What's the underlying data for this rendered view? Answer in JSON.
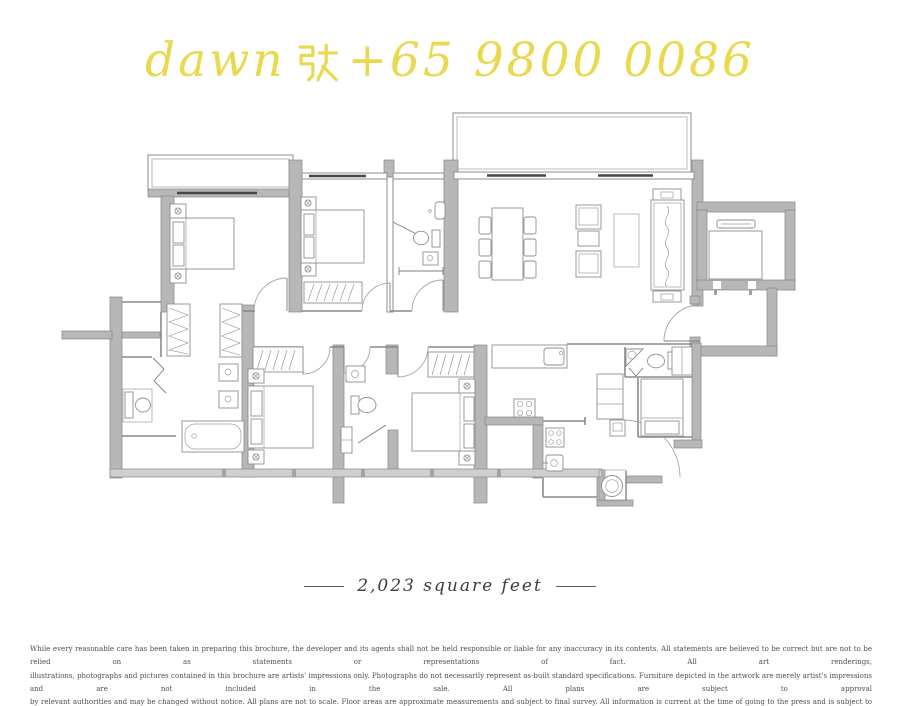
{
  "watermark": {
    "prefix": "dawn",
    "cjk": "张",
    "phone": "+65 9800 0086",
    "full_text": "dawn 张 +65 9800 0086"
  },
  "caption": {
    "area": "2,023 square feet"
  },
  "disclaimer": {
    "lines": [
      "While every reasonable care has been taken in preparing this brochure, the developer and its agents shall not be held responsible or liable for any inaccuracy in its contents. All statements are believed to be correct but are not to be relied on as statements or representations of fact. All art renderings,",
      "illustrations, photographs and pictures contained in this brochure are artists' impressions only. Photographs do not necessarily represent as-built standard specifications. Furniture depicted in the artwork are merely artist's impressions and are not included in the sale. All plans are subject to approval",
      "by relevant authorities and may be changed without notice. All plans are not to scale. Floor areas are approximate measurements and subject to final survey. All information is current at the time of going to the press and is subject to changes as may be required and shall not form part of an offer or contract."
    ]
  },
  "colors": {
    "watermark": "#e8d94e",
    "wall-fill": "#b7b7b7",
    "wall-stroke": "#868686",
    "line": "#7d7d7d",
    "furniture": "#8f8f8f",
    "window-dark": "#474747",
    "caption-text": "#3d3d3d",
    "disclaimer-text": "#4f4f4f",
    "background": "#ffffff"
  }
}
